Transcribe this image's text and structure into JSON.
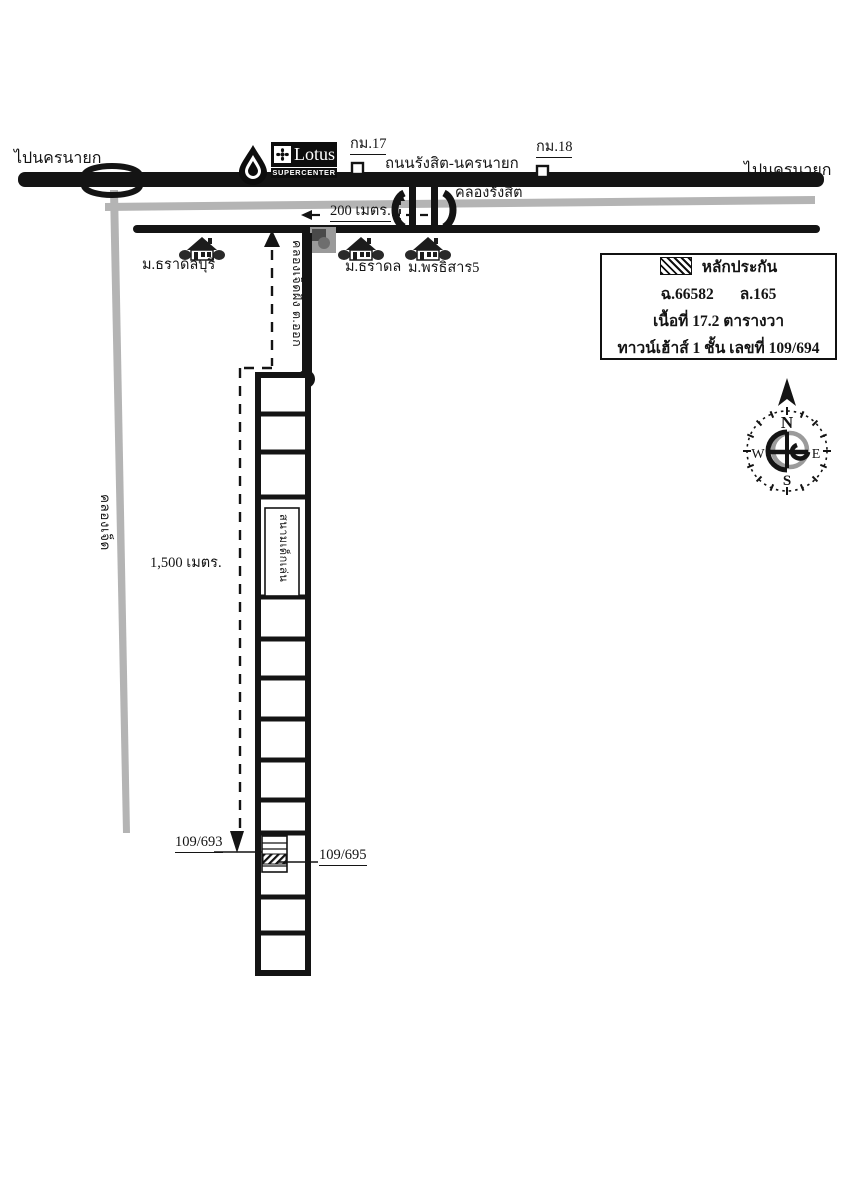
{
  "map": {
    "top": {
      "left_direction": "ไปนครนายก",
      "right_direction": "ไปนครนายก",
      "road_name": "ถนนรังสิต-นครนายก",
      "km17": "กม.17",
      "km18": "กม.18",
      "canal_rangsit": "คลองรังสิต",
      "distance_200": "200 เมตร."
    },
    "lotus_logo": {
      "name": "Lotus",
      "subtitle": "SUPERCENTER"
    },
    "villages": {
      "v1": "ม.ธราดลบุรี",
      "v2": "ม.ธราดล",
      "v3": "ม.พรธิสาร5"
    },
    "soi_label": "คลองเจ็ดฝั่ง ต.ออก",
    "canal_west": "คลองเจ็ด",
    "distance_1500": "1,500 เมตร.",
    "playground": "สนามเด็กเล่น",
    "units": {
      "left": "109/693",
      "right": "109/695"
    },
    "legend": {
      "title": "หลักประกัน",
      "deed_no": "ฉ.66582",
      "land_no": "ล.165",
      "area": "เนื้อที่ 17.2 ตารางวา",
      "detail": "ทาวน์เฮ้าส์ 1 ชั้น เลขที่ 109/694"
    },
    "compass": {
      "n": "N",
      "w": "W",
      "e": "E",
      "s": "S"
    }
  },
  "colors": {
    "road": "#141414",
    "canal": "#b4b4b4",
    "ink": "#141414"
  }
}
